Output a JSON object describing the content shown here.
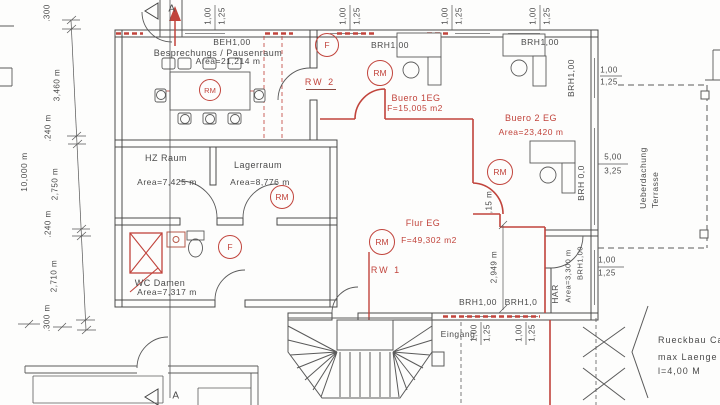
{
  "colors": {
    "accent_red": "#c1443c",
    "ink": "#4a4a4a"
  },
  "rooms": {
    "besprechung": {
      "name": "Besprechungs / Pausenraum",
      "area": "Area=21,214 m"
    },
    "hz": {
      "name": "HZ Raum",
      "area": "Area=7,425 m"
    },
    "lager": {
      "name": "Lagerraum",
      "area": "Area=8,776 m"
    },
    "wc": {
      "name": "WC Damen",
      "area": "Area=7,317 m"
    },
    "buero1": {
      "name": "Buero 1EG",
      "area": "F=15,005 m2"
    },
    "buero2": {
      "name": "Buero 2 EG",
      "area": "Area=23,420 m"
    },
    "flur": {
      "name": "Flur EG",
      "area": "F=49,302 m2"
    },
    "har": {
      "name": "HAR",
      "area": "Area=3,300 m"
    }
  },
  "labels": {
    "beh": "BEH1,00",
    "brh100": "BRH1,00",
    "brh10": "BRH1,0",
    "brh00": "BRH 0,0",
    "rw1": "RW 1",
    "rw2": "RW 2",
    "rm": "RM",
    "f": "F",
    "section": "A",
    "eingang": "Eingang",
    "terrasse1": "Ueberdachung",
    "terrasse2": "Terrasse",
    "rueckbau1": "Rueckbau Ca",
    "rueckbau2": "max Laenge",
    "rueckbau3": "l=4,00 M"
  },
  "dims": {
    "d100": "1,00",
    "d125": "1,25",
    "d500": "5,00",
    "d325": "3,25",
    "d2949": "2,949 m",
    "d15": ",15 m",
    "left": {
      "overall": "10,000 m",
      "a": ".300",
      "b": "3,460 m",
      "c": ".240 m",
      "d": "2,750 m",
      "e": ".240 m",
      "f": "2,710 m",
      "g": ".300 m"
    }
  }
}
